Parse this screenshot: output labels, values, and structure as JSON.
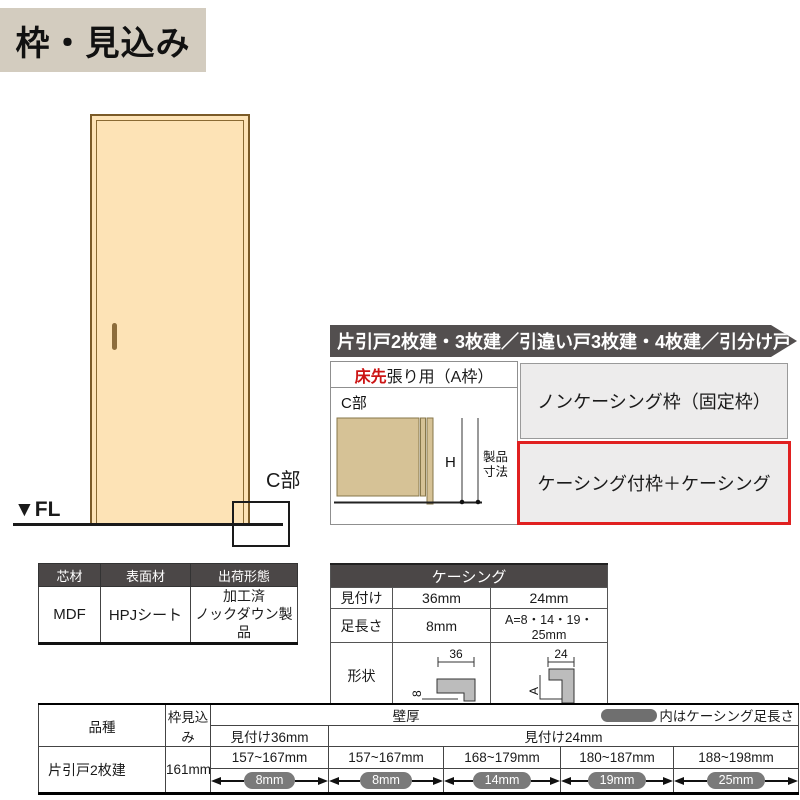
{
  "page_title": "枠・見込み",
  "door_figure": {
    "fl_label": "▼FL",
    "c_section_label": "C部"
  },
  "material_table": {
    "headers": [
      "芯材",
      "表面材",
      "出荷形態"
    ],
    "core_value": "MDF",
    "surface_value": "HPJシート",
    "shipping_line1": "加工済",
    "shipping_line2": "ノックダウン製品"
  },
  "door_types_banner": "片引戸2枚建・3枚建／引違い戸3枚建・4枚建／引分け戸",
  "frame_section": {
    "header_red": "床先",
    "header_rest": "張り用（A枠）",
    "c_label": "C部",
    "h_label": "H",
    "product_dim_line1": "製品",
    "product_dim_line2": "寸法",
    "options": [
      {
        "label": "ノンケーシング枠（固定枠）",
        "highlighted": false
      },
      {
        "label": "ケーシング付枠＋ケーシング",
        "highlighted": true
      }
    ],
    "highlight_color": "#e02020"
  },
  "casing_table": {
    "title": "ケーシング",
    "row_mitsuke": {
      "label": "見付け",
      "w36": "36mm",
      "w24": "24mm"
    },
    "row_ashinaga": {
      "label": "足長さ",
      "w36": "8mm",
      "w24": "A=8・14・19・25mm"
    },
    "row_shape_label": "形状",
    "shape36": {
      "width": "36",
      "leg": "8"
    },
    "shape24": {
      "width": "24",
      "leg": "A"
    }
  },
  "spec_table": {
    "header_kind": "品種",
    "header_depth": "枠見込み",
    "header_wall": "壁厚",
    "legend_note": "内はケーシング足長さ",
    "sub36": "見付け36mm",
    "sub24": "見付け24mm",
    "wall_ranges": [
      "157~167mm",
      "157~167mm",
      "168~179mm",
      "180~187mm",
      "188~198mm"
    ],
    "casing_legs": [
      "8mm",
      "8mm",
      "14mm",
      "19mm",
      "25mm"
    ],
    "rows": [
      {
        "kind": "片引戸2枚建",
        "depth": "161mm"
      }
    ]
  },
  "colors": {
    "title_badge_bg": "#d3ccbf",
    "dark_header": "#4b4747",
    "banner_bg": "#534f4f",
    "door_fill": "#fde3b6",
    "wood_fill": "#d6c296",
    "highlight_red": "#e02020",
    "pill_gray": "#7a7a7a"
  }
}
